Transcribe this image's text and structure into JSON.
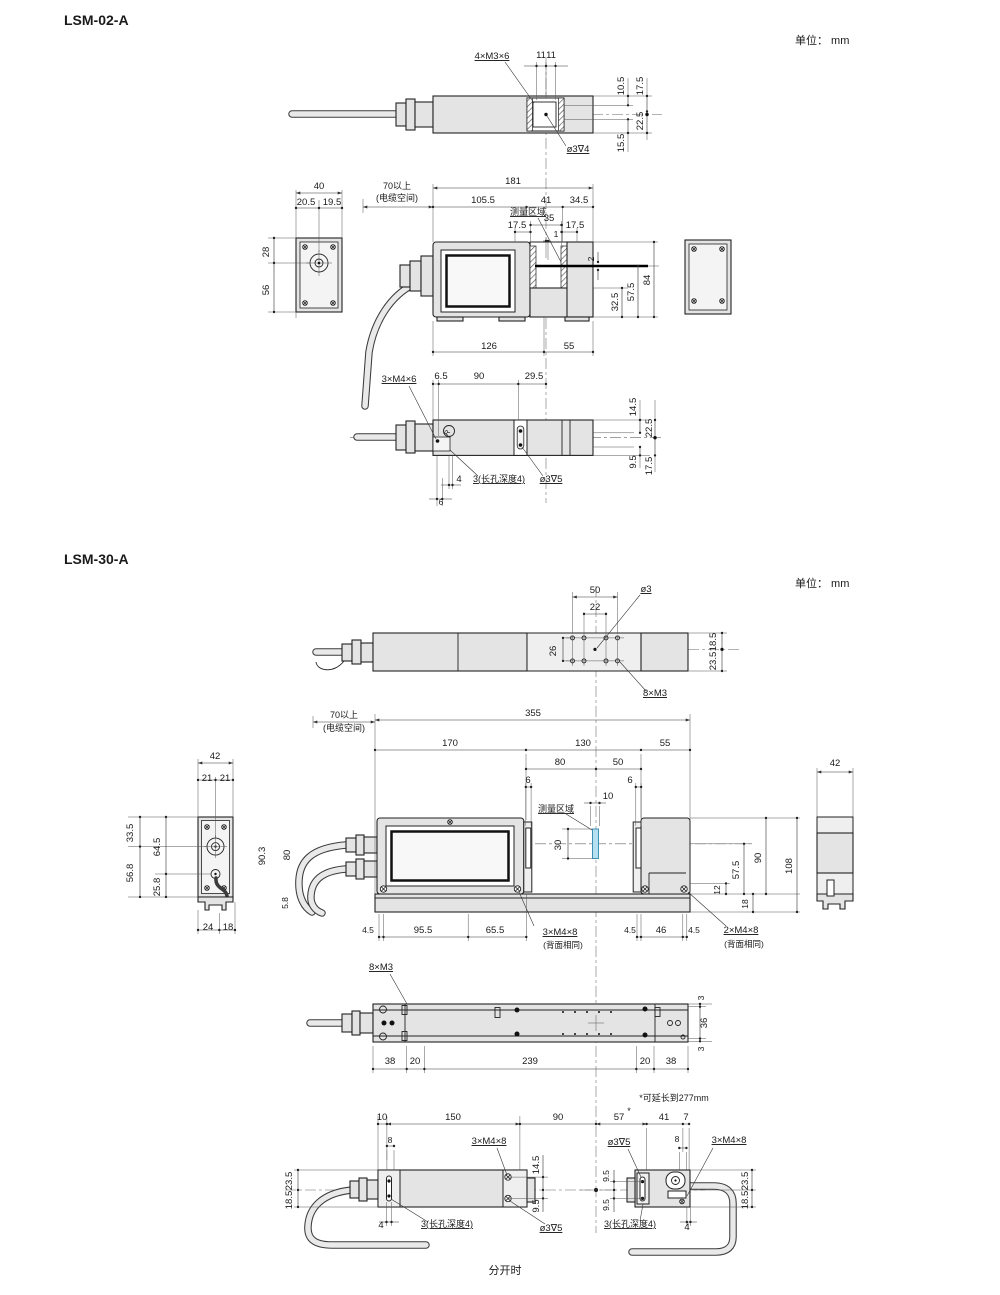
{
  "header": {
    "title_lsm02": "LSM-02-A",
    "title_lsm30": "LSM-30-A",
    "unit_top": "单位： mm",
    "unit_mid": "单位： mm",
    "caption_bottom": "分开时"
  },
  "drawing_labels": {
    "lsm02": [
      {
        "t": "4×M3×6",
        "x": 492,
        "y": 59,
        "u": 1
      },
      {
        "t": "11",
        "x": 541,
        "y": 58
      },
      {
        "t": "11",
        "x": 551,
        "y": 58
      },
      {
        "t": "ø3∇4",
        "x": 578,
        "y": 152,
        "u": 1
      },
      {
        "t": "10.5",
        "x": 624,
        "y": 86,
        "r": -90
      },
      {
        "t": "17.5",
        "x": 643,
        "y": 86,
        "r": -90
      },
      {
        "t": "22.5",
        "x": 643,
        "y": 121,
        "r": -90
      },
      {
        "t": "15.5",
        "x": 624,
        "y": 143,
        "r": -90
      },
      {
        "t": "40",
        "x": 319,
        "y": 189
      },
      {
        "t": "20.5",
        "x": 306,
        "y": 205
      },
      {
        "t": "19.5",
        "x": 332,
        "y": 205
      },
      {
        "t": "28",
        "x": 269,
        "y": 252,
        "r": -90
      },
      {
        "t": "56",
        "x": 269,
        "y": 290,
        "r": -90
      },
      {
        "t": "70以上",
        "x": 397,
        "y": 189,
        "fs": 9
      },
      {
        "t": "(电缆空间)",
        "x": 397,
        "y": 201,
        "fs": 9
      },
      {
        "t": "181",
        "x": 513,
        "y": 184
      },
      {
        "t": "105.5",
        "x": 483,
        "y": 203
      },
      {
        "t": "41",
        "x": 546,
        "y": 203
      },
      {
        "t": "34.5",
        "x": 579,
        "y": 203
      },
      {
        "t": "测量区域",
        "x": 528,
        "y": 215,
        "u": 1,
        "fs": 9
      },
      {
        "t": "35",
        "x": 549,
        "y": 221
      },
      {
        "t": "17.5",
        "x": 517,
        "y": 228
      },
      {
        "t": "17.5",
        "x": 575,
        "y": 228
      },
      {
        "t": "1",
        "x": 556,
        "y": 237,
        "fs": 8.5
      },
      {
        "t": "2",
        "x": 594,
        "y": 259,
        "r": -90,
        "fs": 8.5
      },
      {
        "t": "32.5",
        "x": 618,
        "y": 302,
        "r": -90
      },
      {
        "t": "57.5",
        "x": 634,
        "y": 292,
        "r": -90
      },
      {
        "t": "84",
        "x": 650,
        "y": 280,
        "r": -90
      },
      {
        "t": "126",
        "x": 489,
        "y": 349
      },
      {
        "t": "55",
        "x": 569,
        "y": 349
      },
      {
        "t": "3×M4×6",
        "x": 399,
        "y": 382,
        "u": 1
      },
      {
        "t": "6.5",
        "x": 441,
        "y": 379
      },
      {
        "t": "90",
        "x": 479,
        "y": 379
      },
      {
        "t": "29.5",
        "x": 534,
        "y": 379
      },
      {
        "t": "R",
        "x": 449,
        "y": 434,
        "fs": 7,
        "r": -55
      },
      {
        "t": "14.5",
        "x": 636,
        "y": 407,
        "r": -90
      },
      {
        "t": "22.5",
        "x": 652,
        "y": 428,
        "r": -90
      },
      {
        "t": "9.5",
        "x": 636,
        "y": 462,
        "r": -90
      },
      {
        "t": "17.5",
        "x": 652,
        "y": 466,
        "r": -90
      },
      {
        "t": "4",
        "x": 459,
        "y": 482
      },
      {
        "t": "3(长孔深度4)",
        "x": 499,
        "y": 482,
        "u": 1,
        "fs": 9
      },
      {
        "t": "ø3∇5",
        "x": 551,
        "y": 482,
        "u": 1
      },
      {
        "t": "6",
        "x": 441,
        "y": 505,
        "fs": 8.5
      }
    ],
    "lsm30": [
      {
        "t": "50",
        "x": 595,
        "y": 593
      },
      {
        "t": "22",
        "x": 595,
        "y": 610
      },
      {
        "t": "ø3",
        "x": 646,
        "y": 592,
        "u": 1
      },
      {
        "t": "26",
        "x": 556,
        "y": 651,
        "r": -90
      },
      {
        "t": "8×M3",
        "x": 655,
        "y": 696,
        "u": 1
      },
      {
        "t": "18.5",
        "x": 716,
        "y": 642,
        "r": -90
      },
      {
        "t": "23.5",
        "x": 716,
        "y": 661,
        "r": -90
      },
      {
        "t": "70以上",
        "x": 344,
        "y": 718,
        "fs": 9
      },
      {
        "t": "(电缆空间)",
        "x": 344,
        "y": 731,
        "fs": 9
      },
      {
        "t": "355",
        "x": 533,
        "y": 716
      },
      {
        "t": "170",
        "x": 450,
        "y": 746
      },
      {
        "t": "130",
        "x": 583,
        "y": 746
      },
      {
        "t": "55",
        "x": 665,
        "y": 746
      },
      {
        "t": "80",
        "x": 560,
        "y": 765
      },
      {
        "t": "50",
        "x": 618,
        "y": 765
      },
      {
        "t": "6",
        "x": 528,
        "y": 783
      },
      {
        "t": "6",
        "x": 630,
        "y": 783
      },
      {
        "t": "10",
        "x": 608,
        "y": 799
      },
      {
        "t": "测量区域",
        "x": 556,
        "y": 812,
        "u": 1,
        "fs": 9
      },
      {
        "t": "30",
        "x": 561,
        "y": 845,
        "r": -90
      },
      {
        "t": "42",
        "x": 215,
        "y": 759
      },
      {
        "t": "21",
        "x": 207,
        "y": 781
      },
      {
        "t": "21",
        "x": 225,
        "y": 781
      },
      {
        "t": "33.5",
        "x": 133,
        "y": 833,
        "r": -90
      },
      {
        "t": "64.5",
        "x": 160,
        "y": 847,
        "r": -90
      },
      {
        "t": "56.8",
        "x": 133,
        "y": 873,
        "r": -90
      },
      {
        "t": "25.8",
        "x": 160,
        "y": 887,
        "r": -90
      },
      {
        "t": "90.3",
        "x": 265,
        "y": 856,
        "r": -90
      },
      {
        "t": "80",
        "x": 290,
        "y": 855,
        "r": -90
      },
      {
        "t": "5.8",
        "x": 288,
        "y": 903,
        "r": -90,
        "fs": 8.5
      },
      {
        "t": "24",
        "x": 208,
        "y": 930
      },
      {
        "t": "18",
        "x": 228,
        "y": 930
      },
      {
        "t": "4.5",
        "x": 368,
        "y": 933,
        "fs": 8.5
      },
      {
        "t": "95.5",
        "x": 423,
        "y": 933
      },
      {
        "t": "65.5",
        "x": 495,
        "y": 933
      },
      {
        "t": "3×M4×8",
        "x": 560,
        "y": 935,
        "u": 1
      },
      {
        "t": "(背面相同)",
        "x": 563,
        "y": 948,
        "fs": 8.5
      },
      {
        "t": "4.5",
        "x": 630,
        "y": 933,
        "fs": 8.5
      },
      {
        "t": "46",
        "x": 661,
        "y": 933
      },
      {
        "t": "4.5",
        "x": 694,
        "y": 933,
        "fs": 8.5
      },
      {
        "t": "2×M4×8",
        "x": 741,
        "y": 933,
        "u": 1
      },
      {
        "t": "(背面相同)",
        "x": 744,
        "y": 947,
        "fs": 8.5
      },
      {
        "t": "12",
        "x": 720,
        "y": 890,
        "r": -90,
        "fs": 8.5
      },
      {
        "t": "57.5",
        "x": 739,
        "y": 870,
        "r": -90
      },
      {
        "t": "90",
        "x": 761,
        "y": 858,
        "r": -90
      },
      {
        "t": "18",
        "x": 748,
        "y": 904,
        "r": -90,
        "fs": 8.5
      },
      {
        "t": "108",
        "x": 792,
        "y": 866,
        "r": -90
      },
      {
        "t": "42",
        "x": 835,
        "y": 766
      },
      {
        "t": "8×M3",
        "x": 381,
        "y": 970,
        "u": 1
      },
      {
        "t": "3",
        "x": 704,
        "y": 998,
        "r": -90,
        "fs": 8.5
      },
      {
        "t": "36",
        "x": 707,
        "y": 1023,
        "r": -90
      },
      {
        "t": "3",
        "x": 704,
        "y": 1049,
        "r": -90,
        "fs": 8.5
      },
      {
        "t": "38",
        "x": 390,
        "y": 1064
      },
      {
        "t": "20",
        "x": 415,
        "y": 1064
      },
      {
        "t": "239",
        "x": 530,
        "y": 1064
      },
      {
        "t": "20",
        "x": 645,
        "y": 1064
      },
      {
        "t": "38",
        "x": 671,
        "y": 1064
      },
      {
        "t": "*可延长到277mm",
        "x": 674,
        "y": 1101,
        "fs": 9
      },
      {
        "t": "10",
        "x": 382,
        "y": 1120
      },
      {
        "t": "150",
        "x": 453,
        "y": 1120
      },
      {
        "t": "90",
        "x": 558,
        "y": 1120
      },
      {
        "t": "57",
        "x": 619,
        "y": 1120
      },
      {
        "t": "*",
        "x": 629,
        "y": 1114,
        "fs": 9
      },
      {
        "t": "41",
        "x": 664,
        "y": 1120
      },
      {
        "t": "7",
        "x": 686,
        "y": 1120
      },
      {
        "t": "8",
        "x": 390,
        "y": 1143,
        "fs": 8.5
      },
      {
        "t": "3×M4×8",
        "x": 489,
        "y": 1144,
        "u": 1
      },
      {
        "t": "ø3∇5",
        "x": 619,
        "y": 1145,
        "u": 1
      },
      {
        "t": "8",
        "x": 677,
        "y": 1142,
        "fs": 8.5
      },
      {
        "t": "3×M4×8",
        "x": 729,
        "y": 1143,
        "u": 1
      },
      {
        "t": "23.5",
        "x": 292,
        "y": 1181,
        "r": -90
      },
      {
        "t": "18.5",
        "x": 292,
        "y": 1200,
        "r": -90
      },
      {
        "t": "14.5",
        "x": 539,
        "y": 1165,
        "r": -90
      },
      {
        "t": "9.5",
        "x": 539,
        "y": 1206,
        "r": -90
      },
      {
        "t": "9.5",
        "x": 609,
        "y": 1176,
        "r": -90,
        "fs": 8.5
      },
      {
        "t": "9.5",
        "x": 609,
        "y": 1205,
        "r": -90,
        "fs": 8.5
      },
      {
        "t": "23.5",
        "x": 748,
        "y": 1181,
        "r": -90
      },
      {
        "t": "18.5",
        "x": 748,
        "y": 1200,
        "r": -90
      },
      {
        "t": "4",
        "x": 381,
        "y": 1228
      },
      {
        "t": "3(长孔深度4)",
        "x": 447,
        "y": 1227,
        "u": 1,
        "fs": 9
      },
      {
        "t": "ø3∇5",
        "x": 551,
        "y": 1231,
        "u": 1
      },
      {
        "t": "3(长孔深度4)",
        "x": 630,
        "y": 1227,
        "u": 1,
        "fs": 9
      },
      {
        "t": "4",
        "x": 687,
        "y": 1230
      }
    ]
  }
}
